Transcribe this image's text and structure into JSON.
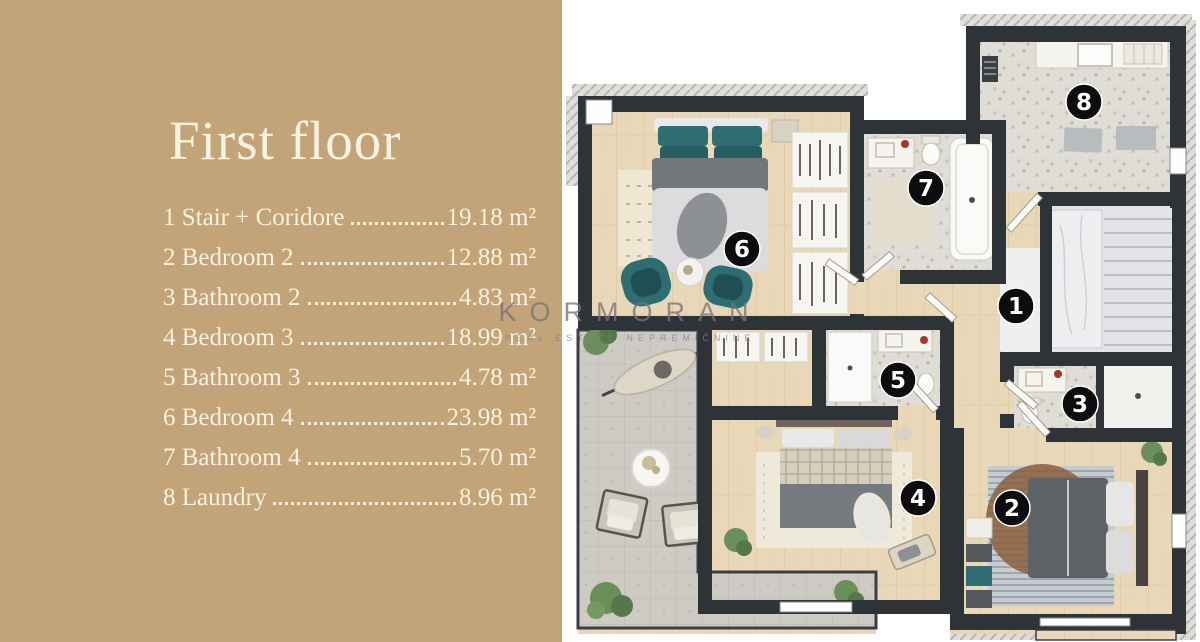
{
  "panel": {
    "title": "First floor",
    "items": [
      {
        "num": "1",
        "name": "Stair + Coridore",
        "area": "19.18 m²"
      },
      {
        "num": "2",
        "name": "Bedroom 2",
        "area": "12.88 m²"
      },
      {
        "num": "3",
        "name": "Bathroom 2",
        "area": "4.83 m²"
      },
      {
        "num": "4",
        "name": "Bedroom 3",
        "area": "18.99 m²"
      },
      {
        "num": "5",
        "name": "Bathroom 3",
        "area": "4.78 m²"
      },
      {
        "num": "6",
        "name": "Bedroom 4",
        "area": "23.98 m²"
      },
      {
        "num": "7",
        "name": "Bathroom 4",
        "area": "5.70 m²"
      },
      {
        "num": "8",
        "name": "Laundry",
        "area": "8.96 m²"
      }
    ]
  },
  "watermark": {
    "brand": "KORMORAN",
    "tagline": "REAL ESTATE NEPREMIČNINE"
  },
  "plan": {
    "badges": [
      {
        "room": "1",
        "x": 1016,
        "y": 306
      },
      {
        "room": "2",
        "x": 1012,
        "y": 508
      },
      {
        "room": "3",
        "x": 1080,
        "y": 404
      },
      {
        "room": "4",
        "x": 918,
        "y": 498
      },
      {
        "room": "5",
        "x": 898,
        "y": 380
      },
      {
        "room": "6",
        "x": 742,
        "y": 249
      },
      {
        "room": "7",
        "x": 926,
        "y": 188
      },
      {
        "room": "8",
        "x": 1084,
        "y": 102
      }
    ]
  },
  "colors": {
    "panel_bg": "#c2a478",
    "panel_text": "#f9f2e0",
    "wall": "#2e3338",
    "wood_floor": "#e9d8b8",
    "stone_floor": "#e0ddd6",
    "terrace_stone": "#cecbc5",
    "teal_accent": "#2e6e72",
    "badge": "#0d0d0f"
  }
}
